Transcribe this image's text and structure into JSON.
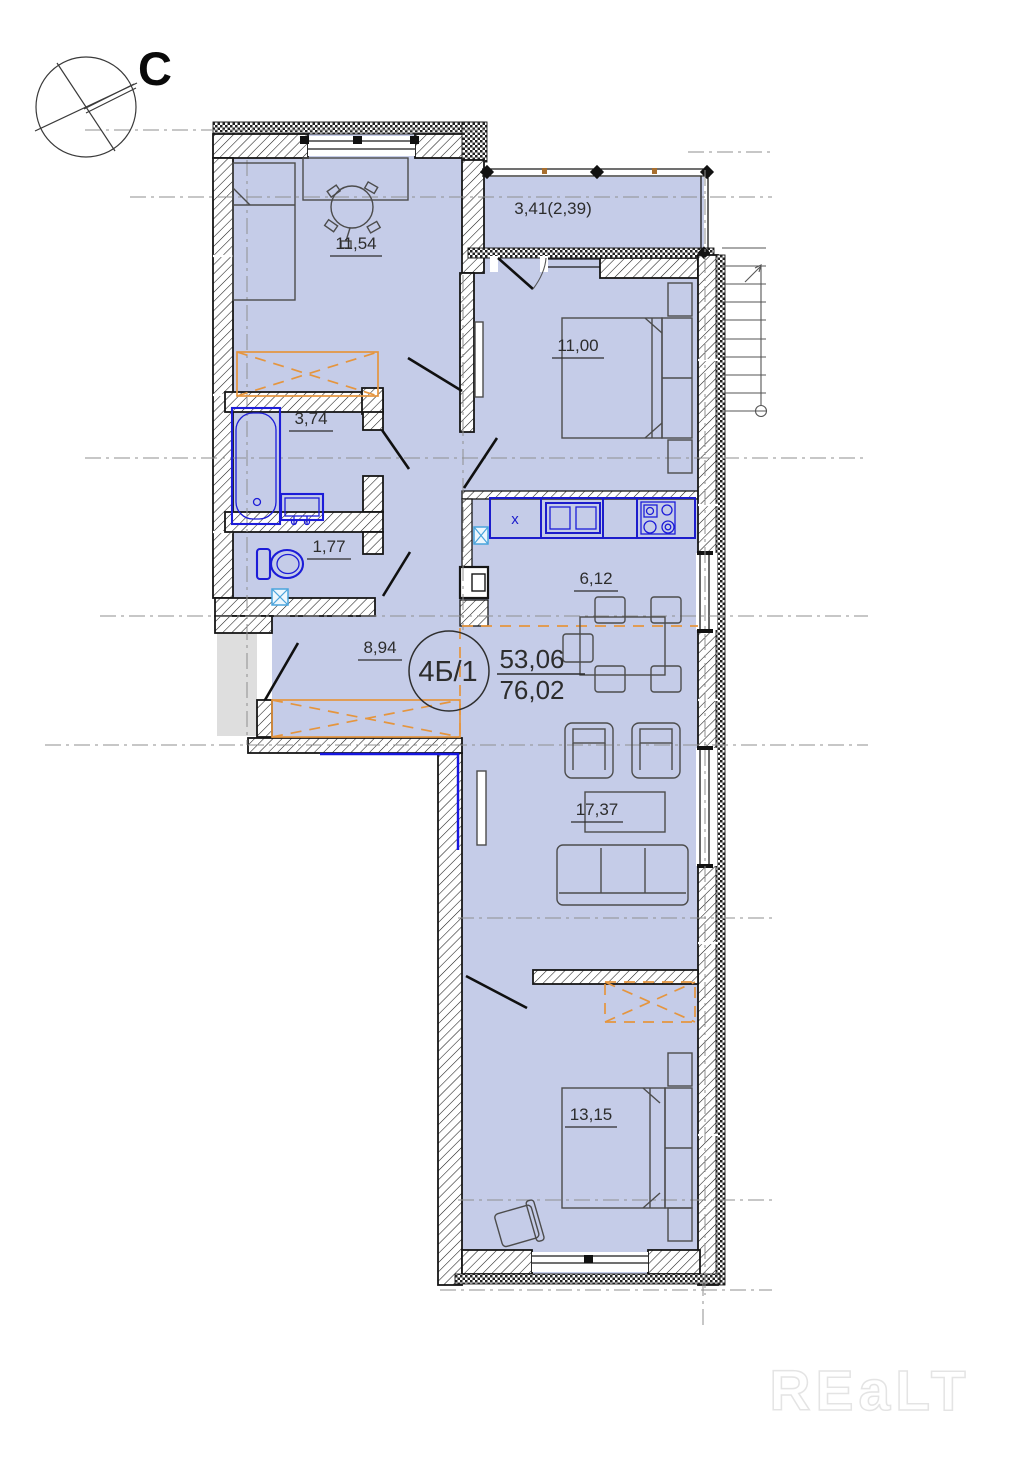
{
  "plan": {
    "unit_label": "4Б/1",
    "area_living": "53,06",
    "area_total": "76,02"
  },
  "compass": {
    "north_label": "С"
  },
  "rooms": [
    {
      "name": "room-11-54",
      "label": "11,54"
    },
    {
      "name": "loggia",
      "label": "3,41(2,39)"
    },
    {
      "name": "bedroom-11-00",
      "label": "11,00"
    },
    {
      "name": "bathroom",
      "label": "3,74"
    },
    {
      "name": "wc",
      "label": "1,77"
    },
    {
      "name": "kitchen",
      "label": "6,12"
    },
    {
      "name": "hall",
      "label": "8,94"
    },
    {
      "name": "living-room",
      "label": "17,37"
    },
    {
      "name": "bedroom-13-15",
      "label": "13,15"
    }
  ],
  "kitchen_counter": {
    "unit_label": "x"
  },
  "watermark": {
    "text": "REaLT"
  },
  "colors": {
    "room_fill": "#c5cce8",
    "landing_gray": "#dedede",
    "fixture_blue": "#1c1cd8",
    "wardrobe_orange": "#e5953e",
    "axis_gray": "#8f8f8f"
  }
}
